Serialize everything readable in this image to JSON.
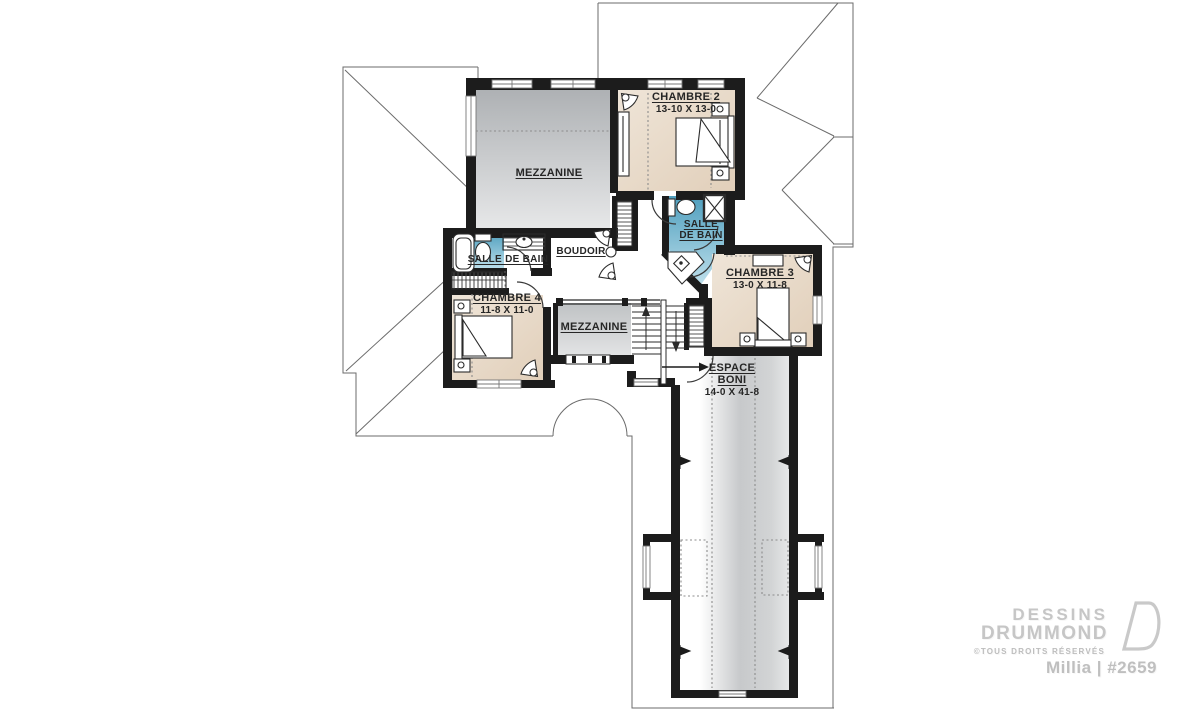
{
  "rooms": {
    "chambre2": {
      "name": "CHAMBRE 2",
      "dim": "13-10 X 13-0"
    },
    "chambre3": {
      "name": "CHAMBRE 3",
      "dim": "13-0 X 11-8"
    },
    "chambre4": {
      "name": "CHAMBRE 4",
      "dim": "11-8 X 11-0"
    },
    "mezzanine_top": {
      "name": "MEZZANINE"
    },
    "mezzanine_mid": {
      "name": "MEZZANINE"
    },
    "salle_de_bain_main": {
      "name": "SALLE DE BAIN"
    },
    "salle_de_bain_2": {
      "line1": "SALLE",
      "line2": "DE BAIN"
    },
    "boudoir": {
      "name": "BOUDOIR"
    },
    "espace_boni": {
      "line1": "ESPACE",
      "line2": "BONI",
      "dim": "14-0 X 41-8"
    }
  },
  "branding": {
    "brand_line1": "DESSINS",
    "brand_line2": "DRUMMOND",
    "rights": "©TOUS DROITS RÉSERVÉS",
    "plan_name": "Millia | #2659"
  },
  "colors": {
    "wall": "#1c1c1c",
    "bedroom": "#e8dac7",
    "bathroom": "#4f9fbe",
    "mezzanine": "#c2c5c7",
    "roofline": "#6b6b6b"
  }
}
